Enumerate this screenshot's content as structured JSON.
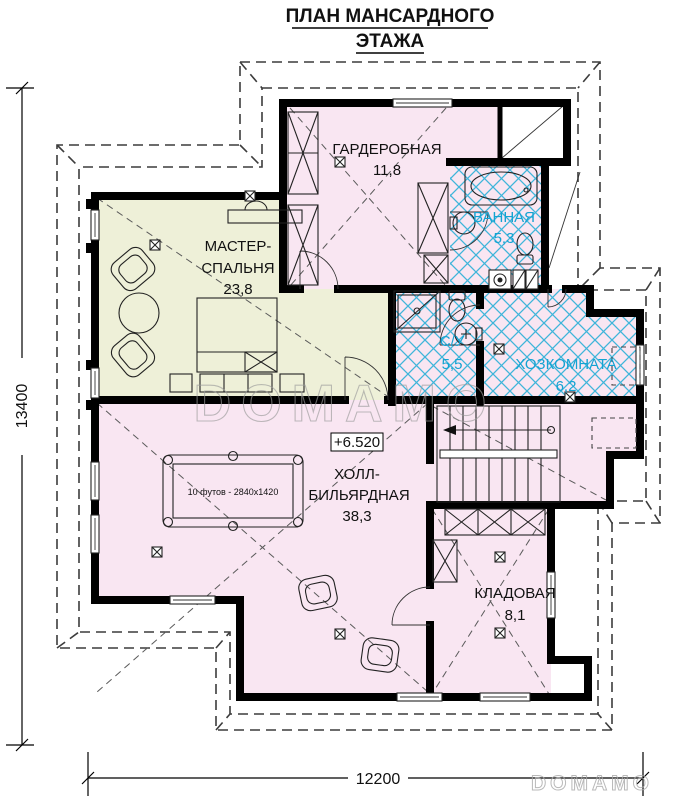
{
  "title": {
    "line1": "ПЛАН МАНСАРДНОГО",
    "line2": "ЭТАЖА"
  },
  "rooms": {
    "wardrobe": {
      "name": "ГАРДЕРОБНАЯ",
      "area": "11,8"
    },
    "bathroom": {
      "name": "ВАННАЯ",
      "area": "5,3"
    },
    "master_bedroom": {
      "name_line1": "МАСТЕР-",
      "name_line2": "СПАЛЬНЯ",
      "area": "23,8"
    },
    "wc": {
      "name": "С/У",
      "area": "5,5"
    },
    "utility": {
      "name": "ХОЗКОМНАТА",
      "area": "6,2"
    },
    "hall_billiard": {
      "name_line1": "ХОЛЛ-",
      "name_line2": "БИЛЬЯРДНАЯ",
      "area": "38,3"
    },
    "storage": {
      "name": "КЛАДОВАЯ",
      "area": "8,1"
    }
  },
  "annotations": {
    "elevation_mark": "+6.520",
    "billiard_table": "10 футов - 2840x1420"
  },
  "dimensions": {
    "left": "13400",
    "bottom": "12200"
  },
  "watermark": {
    "center": "DOMAMO",
    "corner": "DOMAMO"
  },
  "colors": {
    "room_pink": "#f9e6f2",
    "room_green": "#eef0d8",
    "tile_line_blue": "#3fb5da",
    "label_blue": "#14a3d2",
    "wall_black": "#000000"
  }
}
